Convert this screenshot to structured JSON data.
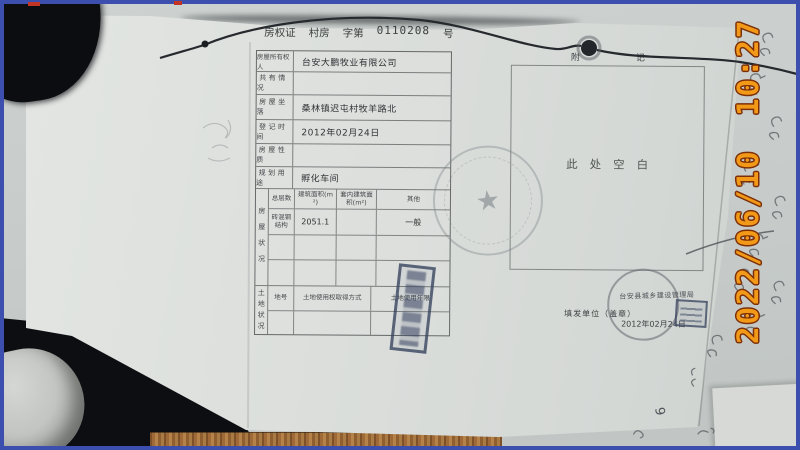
{
  "photo": {
    "timestamp": "2022/06/10 10:27"
  },
  "certificate": {
    "header": {
      "title": "房权证",
      "region_type": "村房",
      "zi_di": "字第",
      "number": "0110208",
      "hao": "号"
    },
    "owner_rows": [
      {
        "label": "房屋所有权人",
        "value": "台安大鹏牧业有限公司"
      },
      {
        "label": "共有情况",
        "value": ""
      },
      {
        "label": "房屋坐落",
        "value": "桑林镇迟屯村牧羊路北"
      },
      {
        "label": "登记时间",
        "value": "2012年02月24日"
      },
      {
        "label": "房屋性质",
        "value": ""
      },
      {
        "label": "规划用途",
        "value": "孵化车间"
      }
    ],
    "housing": {
      "section_label": "房屋状况",
      "columns": [
        "总层数",
        "建筑面积(m²)",
        "套内建筑面积(m²)",
        "其他"
      ],
      "rows": [
        [
          "砖混钢结构",
          "2051.1",
          "",
          "一般"
        ],
        [
          "",
          "",
          "",
          ""
        ],
        [
          "",
          "",
          "",
          ""
        ]
      ]
    },
    "land": {
      "section_label": "土地状况",
      "columns": [
        "地号",
        "土地使用权取得方式",
        "土地使用年限"
      ],
      "rows": [
        [
          "",
          "",
          ""
        ]
      ]
    },
    "appendix": {
      "header": "附记",
      "blank_text": "此处空白"
    },
    "issuer": {
      "label": "填发单位（盖章）",
      "date": "2012年02月24日",
      "stamp_text": "台安县城乡建设管理局"
    }
  },
  "handwriting": {
    "digit": "9"
  },
  "icons": {
    "star": "★"
  },
  "colors": {
    "frame_border": "#3d4fae",
    "timestamp_fill": "#f29a18",
    "timestamp_outline": "#7c2f08",
    "wood": "#a06a38"
  }
}
